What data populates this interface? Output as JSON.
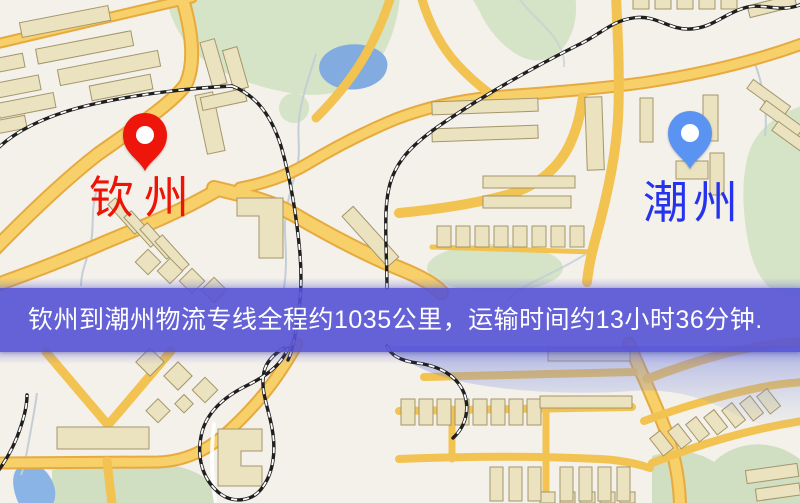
{
  "map": {
    "origin_pin": {
      "label": "钦州",
      "label_color": "#ed1405",
      "pin_color": "#ee150a"
    },
    "destination_pin": {
      "label": "潮州",
      "label_color": "#2533ee",
      "pin_color": "#5b93f2"
    },
    "banner": {
      "text": "钦州到潮州物流专线全程约1035公里，运输时间约13小时36分钟.",
      "background": "rgba(85,82,214,0.9)",
      "text_color": "#ffffff"
    },
    "palette": {
      "land": "#f4f0ea",
      "road": "#f2c351",
      "park": "#cfe0bf",
      "water": "#84aede",
      "railway": "#1f1f1f",
      "building": "#ebe2bf"
    }
  }
}
